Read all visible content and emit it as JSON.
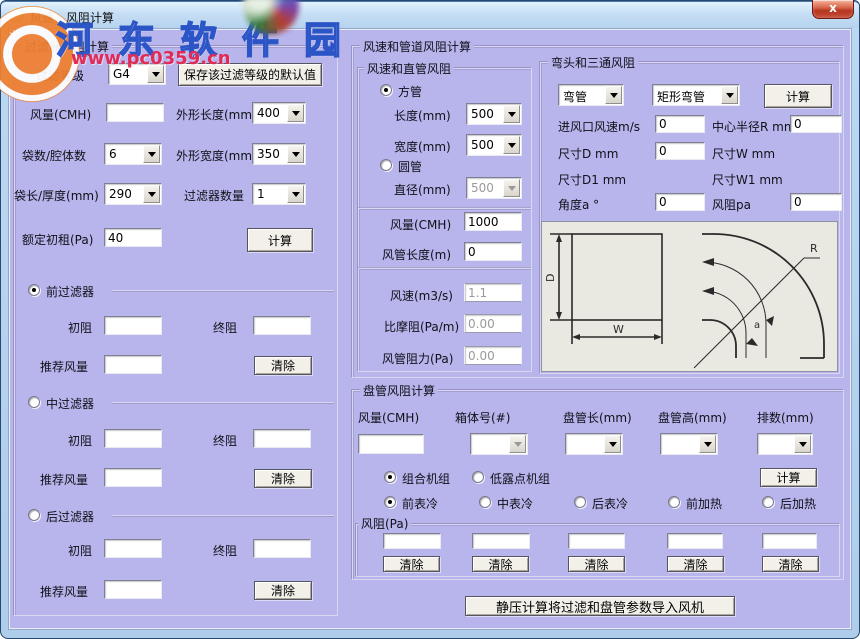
{
  "window": {
    "title": "风速、风阻计算",
    "close": "x"
  },
  "watermark": {
    "site_name": "河东软件园",
    "site_url": "www.pc0359.cn",
    "star": "✶"
  },
  "colors": {
    "client_bg": "#b8b4ec",
    "titlebar_blue": "#c6def5",
    "close_red": "#b5341e",
    "diagram_bg": "#eae9e1",
    "watermark_blue": "#527ee2",
    "watermark_red": "#e22a56"
  },
  "filter": {
    "title": "过滤器风阻计算",
    "grade_label": "过滤等级",
    "grade_value": "G4",
    "save_button": "保存该过滤等级的默认值",
    "flow_label": "风量(CMH)",
    "flow_value": "",
    "length_label": "外形长度(mm)",
    "length_value": "400",
    "bags_label": "袋数/腔体数",
    "bags_value": "6",
    "width_label": "外形宽度(mm)",
    "width_value": "350",
    "baglen_label": "袋长/厚度(mm)",
    "baglen_value": "290",
    "count_label": "过滤器数量",
    "count_value": "1",
    "rated_label": "额定初租(Pa)",
    "rated_value": "40",
    "calc_button": "计算",
    "init_label": "初阻",
    "final_label": "终阻",
    "recommend_label": "推荐风量",
    "clear_button": "清除",
    "sections": [
      {
        "label": "前过滤器",
        "selected": true,
        "init": "",
        "final": "",
        "recommend": ""
      },
      {
        "label": "中过滤器",
        "selected": false,
        "init": "",
        "final": "",
        "recommend": ""
      },
      {
        "label": "后过滤器",
        "selected": false,
        "init": "",
        "final": "",
        "recommend": ""
      }
    ]
  },
  "duct": {
    "outer_title": "风速和管道风阻计算",
    "title": "风速和直管风阻",
    "square_label": "方管",
    "round_label": "圆管",
    "len_label": "长度(mm)",
    "len_value": "500",
    "wid_label": "宽度(mm)",
    "wid_value": "500",
    "dia_label": "直径(mm)",
    "dia_value": "500",
    "flow_label": "风量(CMH)",
    "flow_value": "1000",
    "ductlen_label": "风管长度(m)",
    "ductlen_value": "0",
    "speed_label": "风速(m3/s)",
    "speed_value": "1.1",
    "friction_label": "比摩阻(Pa/m)",
    "friction_value": "0.00",
    "resistance_label": "风管阻力(Pa)",
    "resistance_value": "0.00"
  },
  "elbow": {
    "title": "弯头和三通风阻",
    "type_value": "弯管",
    "shape_value": "矩形弯管",
    "calc_button": "计算",
    "inlet_label": "进风口风速m/s",
    "inlet_value": "0",
    "radius_label": "中心半径R mm",
    "radius_value": "0",
    "d_label": "尺寸D mm",
    "d_value": "0",
    "w_label": "尺寸W mm",
    "d1_label": "尺寸D1 mm",
    "w1_label": "尺寸W1 mm",
    "angle_label": "角度a °",
    "angle_value": "0",
    "res_label": "风阻pa",
    "res_value": "0",
    "diagram": {
      "d": "D",
      "w": "W",
      "r": "R",
      "a": "a"
    }
  },
  "coil": {
    "title": "盘管风阻计算",
    "headers": [
      "风量(CMH)",
      "箱体号(#)",
      "盘管长(mm)",
      "盘管高(mm)",
      "排数(mm)"
    ],
    "values": [
      "",
      "",
      "",
      "",
      ""
    ],
    "unit_radios": [
      "组合机组",
      "低露点机组"
    ],
    "calc_button": "计算",
    "pos_radios": [
      "前表冷",
      "中表冷",
      "后表冷",
      "前加热",
      "后加热"
    ],
    "res_label": "风阻(Pa)",
    "res_values": [
      "",
      "",
      "",
      "",
      ""
    ],
    "clear_button": "清除"
  },
  "footer": {
    "import_button": "静压计算将过滤和盘管参数导入风机"
  }
}
